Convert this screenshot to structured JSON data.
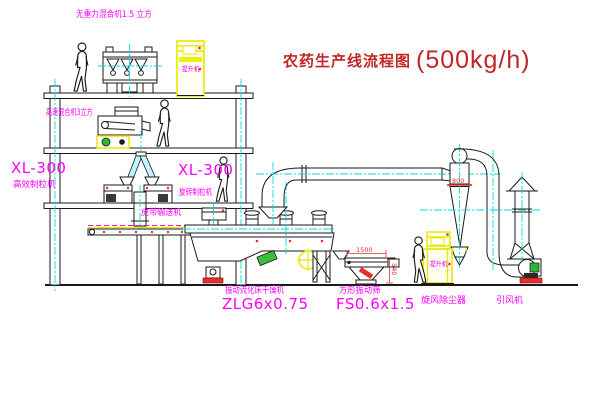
{
  "title": {
    "text": "农药生产线流程图",
    "capacity": "(500kg/h)"
  },
  "equipment_labels": {
    "gravity_mixer": "无重力混合机1.5 立方",
    "speed_mixer": "高速混合机3立方",
    "granulator_left_model": "XL-300",
    "granulator_left_name": "高效制粒机",
    "granulator_right_model": "XL-300",
    "granulator_right_name": "旋转制粒机",
    "belt_conveyor": "皮带输送机",
    "dryer_name": "振动流化床干燥机",
    "dryer_model": "ZLG6x0.75",
    "screen_name": "方形振动筛",
    "screen_model": "FS0.6x1.5",
    "cyclone": "旋风除尘器",
    "fan": "引风机",
    "elevator_top": "提升机",
    "elevator_right": "提升机"
  },
  "dimensions": {
    "screen_length": "1500",
    "screen_height": "540",
    "cyclone_flange": "800"
  },
  "colors": {
    "label_magenta": "#FF00FF",
    "title_red": "#C22626",
    "dimension_red": "#E33030",
    "centerline_cyan": "#00DEDE",
    "equipment_yellow": "#E8E800",
    "motor_green": "#2FB52F",
    "line_black": "#1A1A1A",
    "background": "#FFFFFF"
  }
}
